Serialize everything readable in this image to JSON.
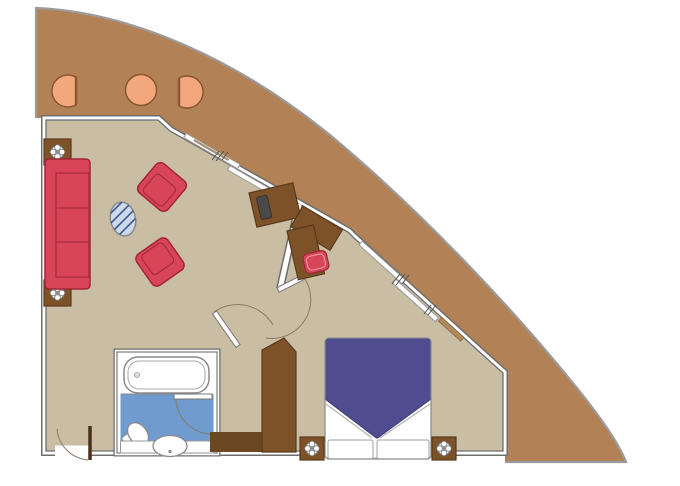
{
  "plan": {
    "kind": "cruise-suite-floor-plan",
    "rooms": [
      "balcony",
      "living-room",
      "bedroom",
      "bathroom",
      "entry-hall"
    ],
    "balcony_furniture": [
      "balcony-chair",
      "balcony-table",
      "balcony-chair"
    ],
    "living_furniture": [
      "sofa",
      "side-table-lamp",
      "side-table-lamp",
      "armchair",
      "armchair",
      "glass-coffee-table",
      "tv-cabinet",
      "corner-cabinet",
      "vanity-desk",
      "stool"
    ],
    "bedroom_furniture": [
      "double-bed",
      "nightstand-lamp",
      "nightstand-lamp",
      "wardrobe"
    ],
    "bathroom_fixtures": [
      "bathtub",
      "toilet",
      "sink-counter"
    ],
    "doors": [
      "entry-door",
      "bathroom-door",
      "interior-door",
      "interior-door",
      "sliding-balcony-door",
      "sliding-balcony-door"
    ]
  },
  "colors": {
    "page_bg": "#ffffff",
    "balcony_floor": "#b28256",
    "interior_floor": "#c9bda3",
    "wall_core": "#ffffff",
    "wall_edge": "#6e6e6e",
    "hull_line": "#9b9b9b",
    "upholstery_red": "#d94558",
    "upholstery_red_dark": "#a22438",
    "cushion_line": "#a82a40",
    "wood": "#7d5229",
    "wood_dark": "#5a3a1c",
    "wood_floor_dark": "#6b4722",
    "bed_blue": "#4f4d90",
    "bed_blue_dark": "#3c3b70",
    "bath_blue": "#6f9bce",
    "fixture_white": "#ffffff",
    "fixture_line": "#8a8a8a",
    "peach": "#f2a87c",
    "peach_line": "#8a5530",
    "glass_blue": "#ccd9ea",
    "glass_line": "#3b5a8c",
    "tv_dark": "#4b4947",
    "door_leaf_dark": "#4a3018",
    "arc_line": "#8a7a62",
    "scribble": "#4a4a4a"
  }
}
